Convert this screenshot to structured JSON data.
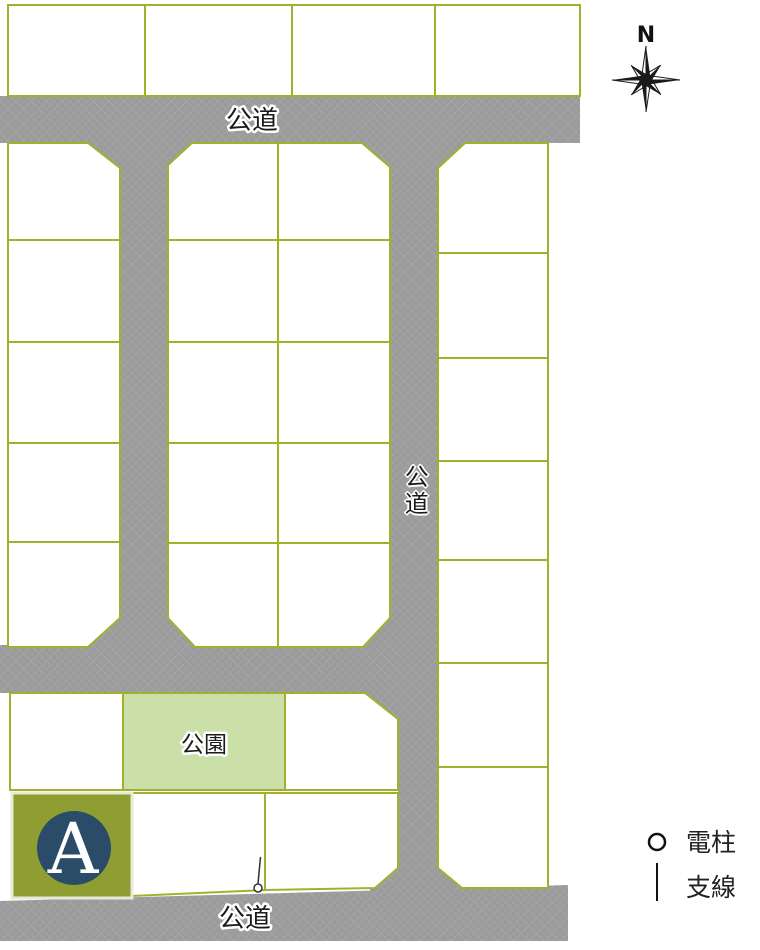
{
  "labels": {
    "road_top": "公道",
    "road_right": "公道",
    "road_bottom": "公道",
    "park": "公園",
    "plot_a": "A",
    "compass_north": "N"
  },
  "legend": {
    "items": [
      {
        "symbol": "circle",
        "label": "電柱"
      },
      {
        "symbol": "vertical-line",
        "label": "支線"
      }
    ]
  },
  "colors": {
    "road_gray": "#9c9c9c",
    "plot_border_green": "#a0b22b",
    "park_fill_green": "#cbdfa9",
    "plot_a_olive": "#8e9e33",
    "plot_a_circle_navy": "#2a4c68",
    "label_text": "#1a1a1a"
  },
  "plot_counts": {
    "top_row": 4,
    "left_column": 5,
    "middle_block": 10,
    "right_column": 7,
    "park_block_plots": 2,
    "bottom_row": 3
  }
}
